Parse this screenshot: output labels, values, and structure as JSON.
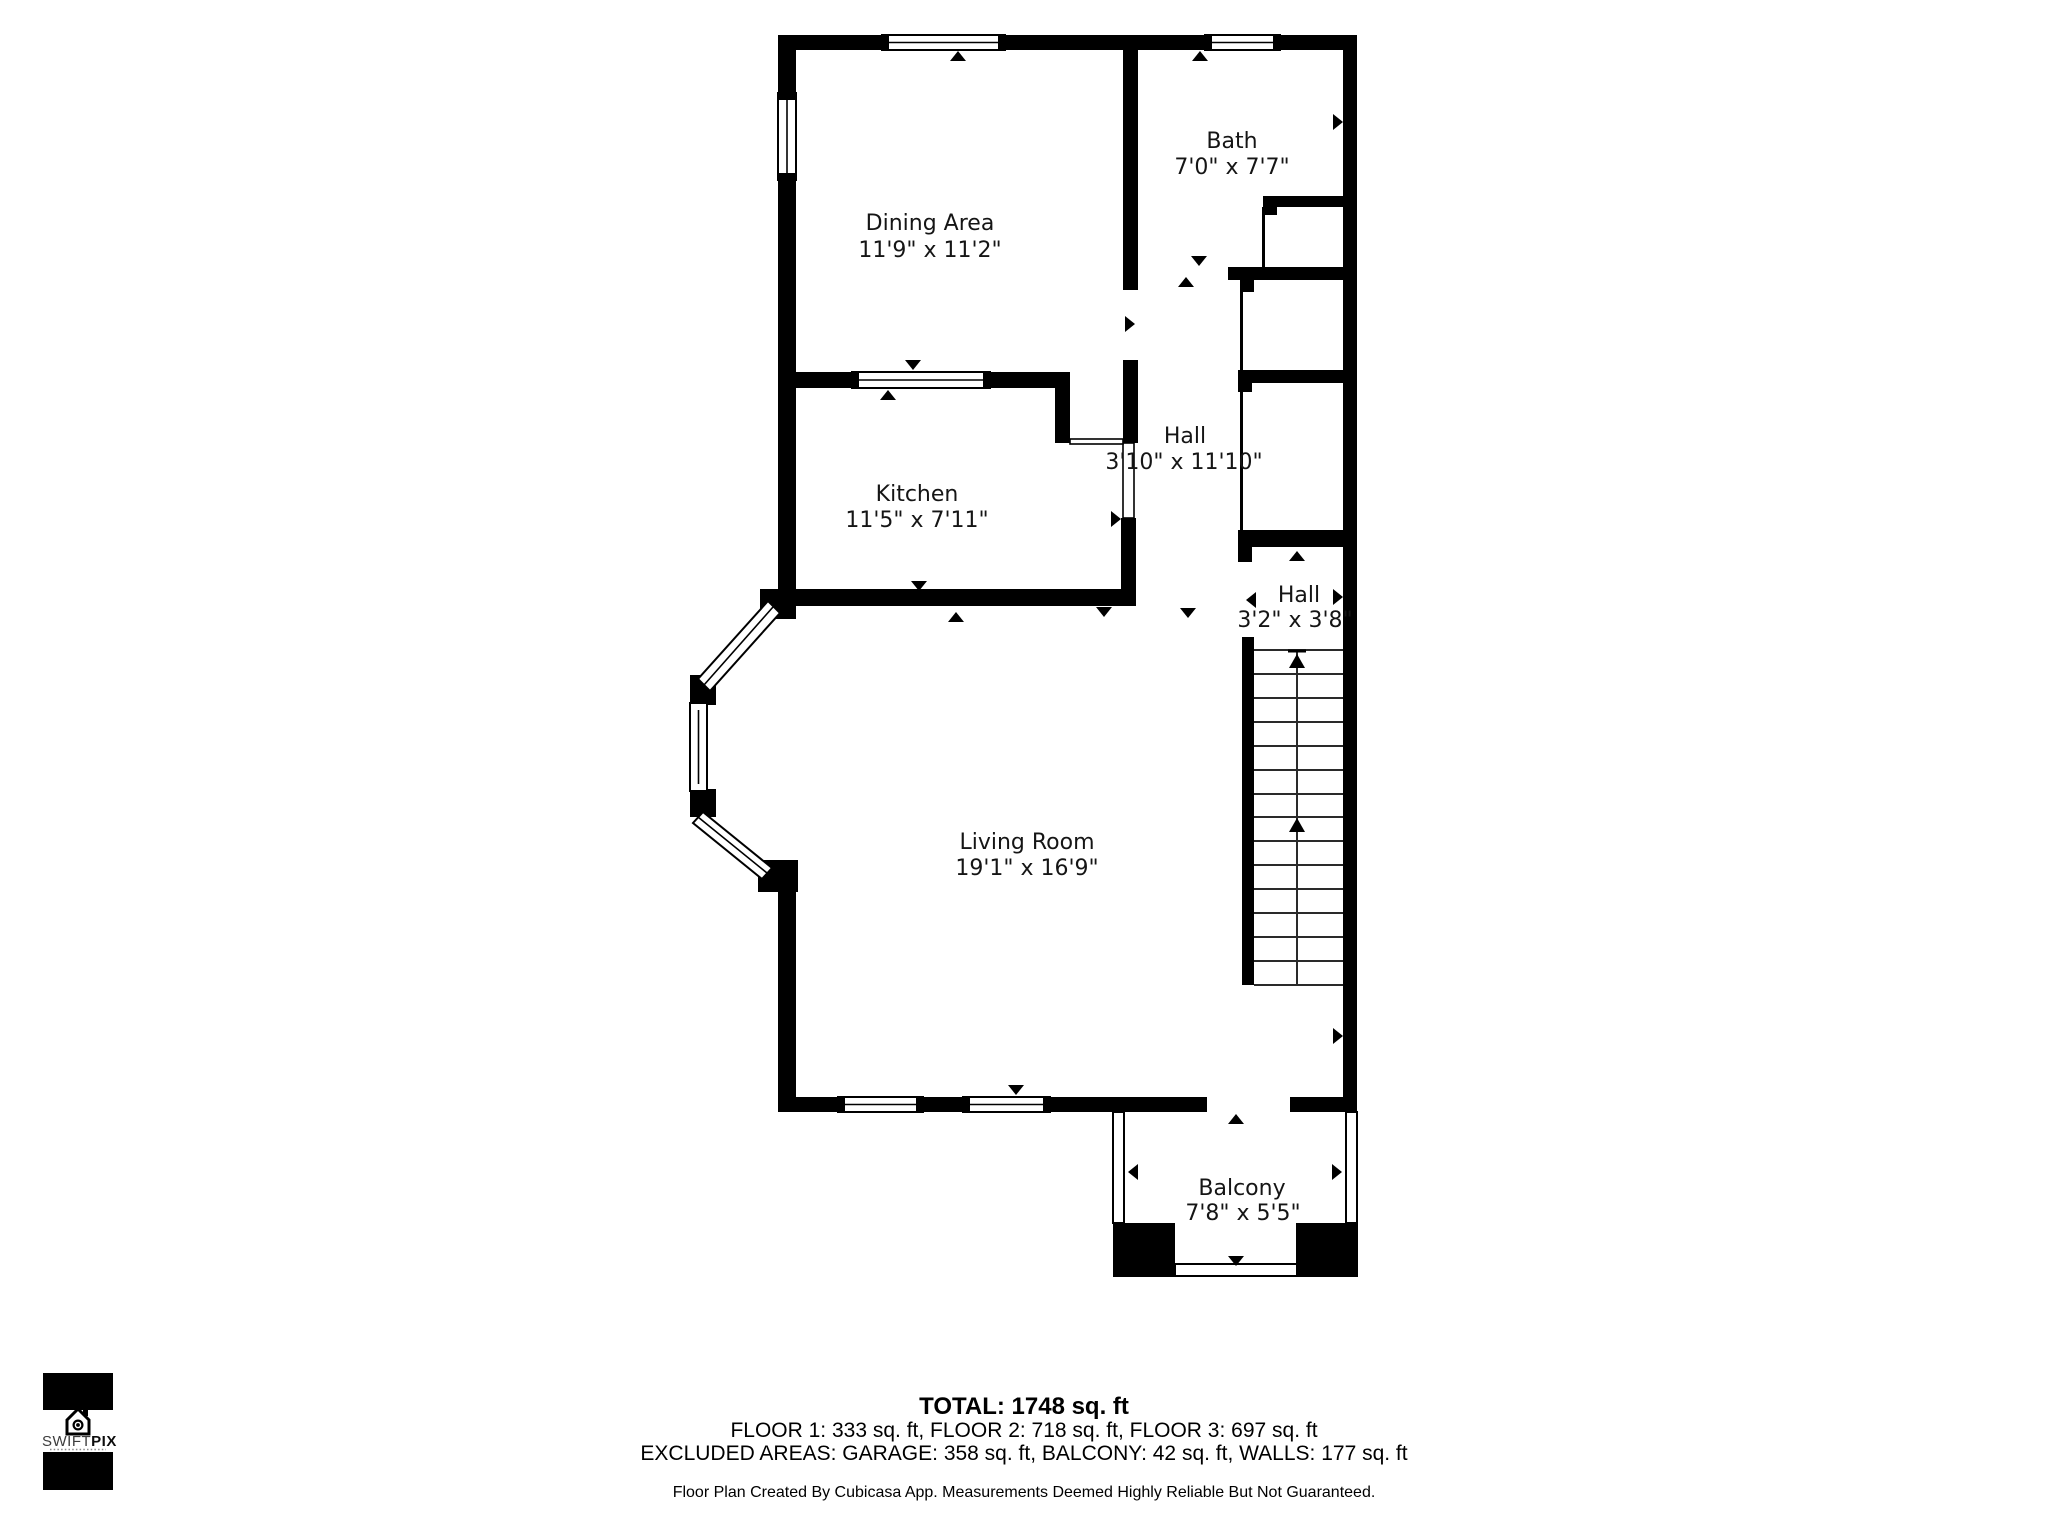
{
  "plan": {
    "rooms": [
      {
        "name": "Dining Area",
        "dims": "11'9\" x 11'2\""
      },
      {
        "name": "Bath",
        "dims": "7'0\" x 7'7\""
      },
      {
        "name": "Kitchen",
        "dims": "11'5\" x 7'11\""
      },
      {
        "name": "Hall",
        "dims": "3'10\" x 11'10\""
      },
      {
        "name": "Hall",
        "dims": "3'2\" x 3'8\""
      },
      {
        "name": "Living Room",
        "dims": "19'1\" x 16'9\""
      },
      {
        "name": "Balcony",
        "dims": "7'8\" x 5'5\""
      }
    ]
  },
  "summary": {
    "total": "TOTAL: 1748 sq. ft",
    "floors": "FLOOR 1: 333 sq. ft, FLOOR 2: 718 sq. ft, FLOOR 3: 697 sq. ft",
    "excluded": "EXCLUDED AREAS: GARAGE: 358 sq. ft, BALCONY: 42 sq. ft, WALLS: 177 sq. ft",
    "disclaimer": "Floor Plan Created By Cubicasa App. Measurements Deemed Highly Reliable But Not Guaranteed."
  },
  "logo": {
    "brand_part1": "SWIFT",
    "brand_part2": "PIX"
  },
  "colors": {
    "wall": "#000000",
    "background": "#ffffff"
  }
}
